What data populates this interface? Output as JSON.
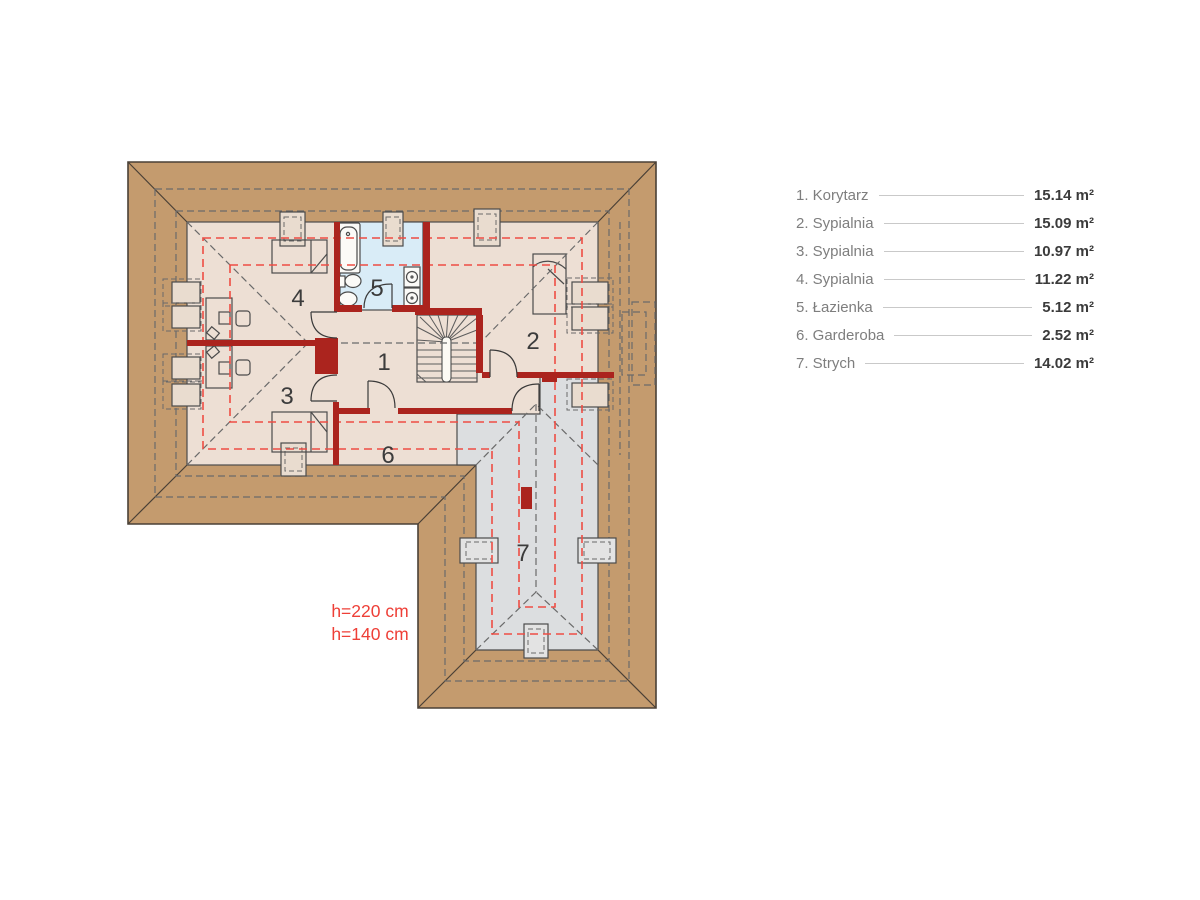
{
  "plan": {
    "room_numbers": [
      "1",
      "2",
      "3",
      "4",
      "5",
      "6",
      "7"
    ],
    "height_labels": [
      "h=220 cm",
      "h=140 cm"
    ],
    "colors": {
      "roof_band": "#c49b6e",
      "floor": "#eddfd4",
      "bathroom_floor": "#d9ecf7",
      "attic_floor": "#dcdee0",
      "wall": "#ab241e",
      "height_dash_line": "#ee4d44",
      "height_text": "#ee3f37"
    }
  },
  "legend": {
    "items": [
      {
        "label": "1. Korytarz",
        "area": "15.14 m²"
      },
      {
        "label": "2. Sypialnia",
        "area": "15.09 m²"
      },
      {
        "label": "3. Sypialnia",
        "area": "10.97 m²"
      },
      {
        "label": "4. Sypialnia",
        "area": "11.22 m²"
      },
      {
        "label": "5. Łazienka",
        "area": "5.12 m²"
      },
      {
        "label": "6. Garderoba",
        "area": "2.52 m²"
      },
      {
        "label": "7. Strych",
        "area": "14.02 m²"
      }
    ]
  }
}
